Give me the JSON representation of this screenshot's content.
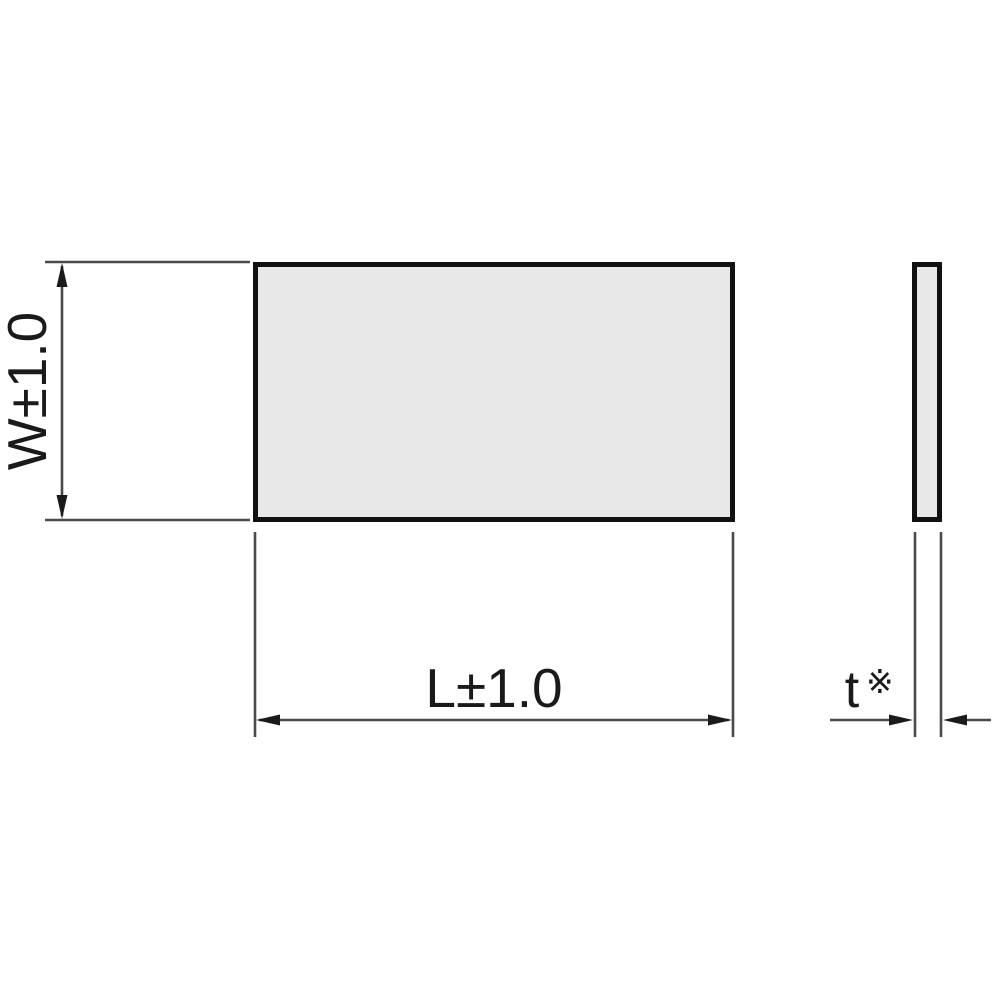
{
  "drawing": {
    "type": "technical-dimension-drawing",
    "subject": "rectangular-flat-plate-two-views",
    "labels": {
      "width_dimension": "W±1.0",
      "length_dimension": "L±1.0",
      "thickness_dimension": "t",
      "thickness_reference_mark": "※"
    },
    "colors": {
      "background": "#ffffff",
      "plate_fill": "#e8e8e8",
      "plate_outline": "#111111",
      "dimension_line": "#4a4a4a",
      "text": "#1a1a1a"
    }
  }
}
